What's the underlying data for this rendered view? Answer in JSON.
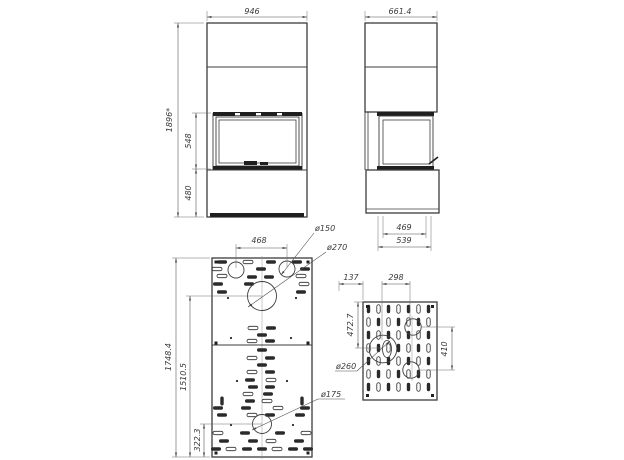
{
  "drawing": {
    "title": "fireplace-technical-drawing",
    "front_view": {
      "width": "946",
      "height": "1896*",
      "firebox_height": "548",
      "base_height": "480"
    },
    "side_view": {
      "depth": "661.4",
      "glass_depth": "469",
      "base_depth": "539"
    },
    "base_panel": {
      "top_holes_span": "468",
      "small_hole_dia": "ø150",
      "large_hole_dia": "ø270",
      "bottom_hole_dia": "ø175",
      "length": "1748.4",
      "large_hole_offset": "1510.5",
      "bottom_hole_offset": "322.3"
    },
    "side_panel": {
      "edge_offset": "137",
      "holes_span": "298",
      "top_offset": "472.7",
      "holes_vertical_span": "410",
      "large_hole_dia": "ø260"
    },
    "colors": {
      "line": "#3c3c3c",
      "fill_dark": "#1f1f1f",
      "background": "#ffffff"
    }
  }
}
